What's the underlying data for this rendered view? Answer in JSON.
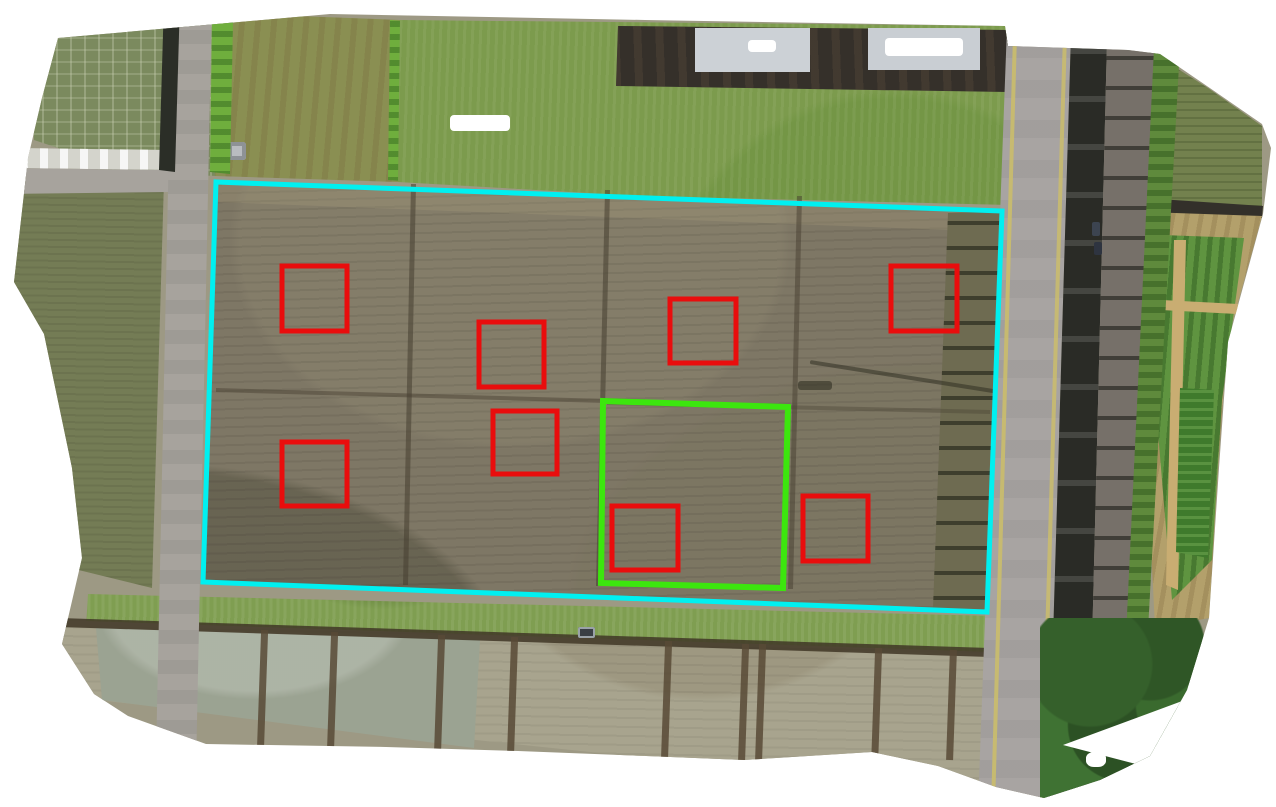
{
  "scene": {
    "type": "drone-orthomosaic-aerial-photo",
    "subject": "farmland with rice paddies, roads and survey annotation overlays",
    "width": 1276,
    "height": 807,
    "background_color": "#ffffff"
  },
  "palette": {
    "survey_boundary_cyan": "#00f0f0",
    "subplot_boundary_green": "#3ce60e",
    "sample_plot_red": "#e90d0d",
    "tilled_field_olive": "#7e7765",
    "grass_green": "#7c9b4d",
    "paddy_tan": "#a8a48e",
    "road_gray": "#a8a4a2"
  },
  "annotations": {
    "field_boundary": {
      "label": "survey-field-boundary",
      "color": "#00f0f0",
      "stroke_width": 5,
      "points": [
        [
          216,
          182
        ],
        [
          1002,
          211
        ],
        [
          987,
          612
        ],
        [
          203,
          582
        ]
      ]
    },
    "subplot_boundary": {
      "label": "subplot-boundary",
      "color": "#3ce60e",
      "stroke_width": 6,
      "points": [
        [
          603,
          401
        ],
        [
          788,
          407
        ],
        [
          783,
          588
        ],
        [
          601,
          583
        ]
      ]
    },
    "sample_plots": {
      "label": "sample-plot-boxes",
      "color": "#e90d0d",
      "stroke_width": 5,
      "boxes": [
        {
          "x": 282,
          "y": 266,
          "w": 65,
          "h": 65
        },
        {
          "x": 891,
          "y": 266,
          "w": 66,
          "h": 65
        },
        {
          "x": 670,
          "y": 299,
          "w": 66,
          "h": 64
        },
        {
          "x": 479,
          "y": 322,
          "w": 65,
          "h": 65
        },
        {
          "x": 493,
          "y": 411,
          "w": 64,
          "h": 63
        },
        {
          "x": 282,
          "y": 442,
          "w": 65,
          "h": 64
        },
        {
          "x": 612,
          "y": 506,
          "w": 66,
          "h": 64
        },
        {
          "x": 803,
          "y": 496,
          "w": 65,
          "h": 65
        }
      ]
    }
  }
}
